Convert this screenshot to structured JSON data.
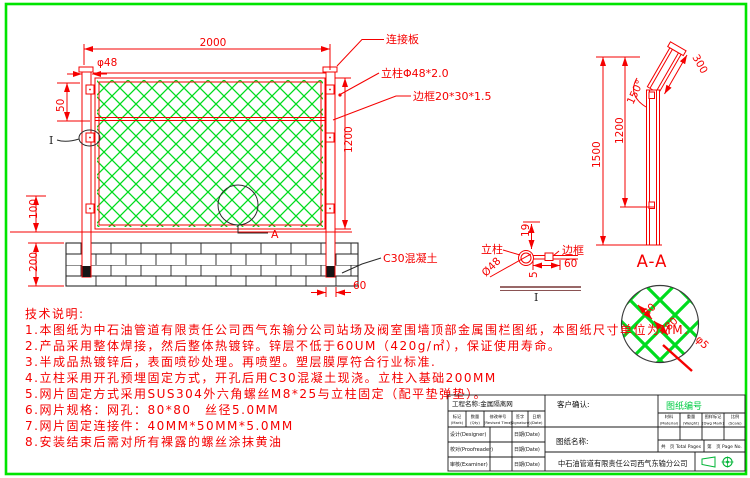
{
  "colors": {
    "line_red": "#f50000",
    "mesh_green": "#00dc1e",
    "border_green": "#00e400",
    "ink_black": "#1a1a1a",
    "drawing_no_green": "#00cc44"
  },
  "front_view": {
    "dim_width": "2000",
    "dim_post_dia": "φ48",
    "dim_top_gap": "50",
    "dim_height": "1200",
    "dim_base": "100",
    "dim_wall": "200",
    "dim_embed": "60",
    "label_plate": "连接板",
    "label_post": "立柱Φ48*2.0",
    "label_frame": "边框20*30*1.5",
    "label_concrete": "C30混凝土",
    "label_section": "A",
    "label_detail": "I"
  },
  "side_view": {
    "dim_total": "1500",
    "dim_panel": "1200",
    "dim_top": "300",
    "dim_angle": "150°",
    "label_section": "A-A"
  },
  "detail_i": {
    "dim_offset": "19",
    "label_post": "立柱",
    "dim_dia": "Ø48",
    "label_frame": "边框",
    "dim_len": "60",
    "dim_thk": "5",
    "label_mark": "I"
  },
  "mesh_detail": {
    "dim_w": "80",
    "dim_h": "80",
    "dim_wire": "φ5"
  },
  "tech_notes": {
    "title": "技术说明:",
    "items": [
      "1.本图纸为中石油管道有限责任公司西气东输分公司站场及阀室围墙顶部金属围栏图纸，本图纸尺寸单位为MM.",
      "2.产品采用整体焊接，然后整体热镀锌。锌层不低于60UM（420g/㎡），保证使用寿命。",
      "3.半成品热镀锌后，表面喷砂处理。再喷塑。塑层膜厚符合行业标准.",
      "4.立柱采用开孔预埋固定方式，开孔后用C30混凝土现浇。立柱入基础200MM",
      "5.网片固定方式采用SUS304外六角螺丝M8*25与立柱固定（配平垫弹垫）。",
      "6.网片规格：网孔：80*80　丝径5.0MM",
      "7.网片固定连接件：40MM*50MM*5.0MM",
      "8.安装结束后需对所有裸露的螺丝涂抹黄油"
    ]
  },
  "title_block": {
    "project": "工程名称:金属隔离网",
    "customer": "客户确认:",
    "drawing_no": "图纸编号",
    "drawing_name": "图纸名称:",
    "company": "中石油管道有限责任公司西气东输分公司",
    "rev_cols": [
      {
        "zh": "标记",
        "en": "(Mark)"
      },
      {
        "zh": "数量",
        "en": "(Qty)"
      },
      {
        "zh": "修改单号",
        "en": "(Revised Time)"
      },
      {
        "zh": "签字",
        "en": "(Signature)"
      },
      {
        "zh": "日期",
        "en": "(Date)"
      }
    ],
    "sign_rows": [
      {
        "role": "设计(Designer)",
        "date": "日期(Date)"
      },
      {
        "role": "校对(Proofreader)",
        "date": "日期(Date)"
      },
      {
        "role": "审核(Examiner)",
        "date": "日期(Date)"
      }
    ],
    "spec_cols": [
      {
        "zh": "材料",
        "en": "(Material)"
      },
      {
        "zh": "重量",
        "en": "(Weight)"
      },
      {
        "zh": "图样标记",
        "en": "(Dwg Mark)"
      },
      {
        "zh": "比例",
        "en": "(Scale)"
      }
    ],
    "pages_total": "共　页 Total Pages",
    "pages_no": "第　页 Page No."
  }
}
